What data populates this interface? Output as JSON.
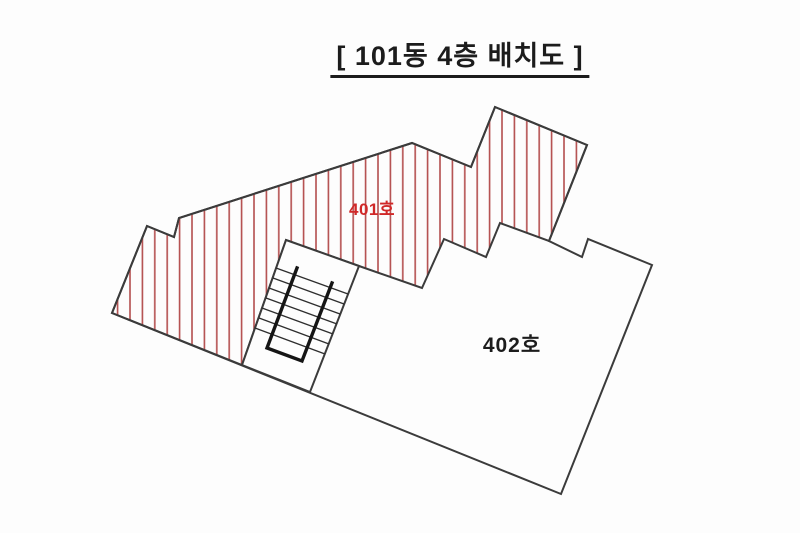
{
  "title": {
    "text": "[ 101동 4층 배치도 ]"
  },
  "units": [
    {
      "id": "401",
      "label": "401호",
      "style": "red-hatched"
    },
    {
      "id": "402",
      "label": "402호",
      "style": "plain"
    }
  ],
  "colors": {
    "background": "#fdfdfd",
    "outline": "#3b3b3b",
    "hatch_line": "#b34d4d",
    "unit401_label": "#d02828",
    "text": "#1c1c1c"
  },
  "hatch": {
    "spacing": 12.4,
    "line_width": 1.6,
    "direction": "vertical"
  },
  "geometry": {
    "outline": "112,313 147,226 174,237 179,218 412,143 471,167 495,107 587,145 549,241 582,257 588,239 652,265 561,494",
    "unit401": "112,313 147,226 174,237 179,218 412,143 471,167 495,107 587,145 549,241 500,223 486,257 444,239 422,288 359,266 286,240 242,365",
    "staircase": "286,240 359,266 310,392 242,365",
    "stair_rail": "297,268 267,348 302,361 332,283",
    "stair_steps": [
      "276,268 348,294",
      "273,278 344,304",
      "269,288 340,314",
      "266,298 337,324",
      "262,308 333,334",
      "259,318 329,344",
      "255,328 325,354"
    ]
  },
  "labels": {
    "unit401": {
      "x": "372",
      "y": "215"
    },
    "unit402": {
      "x": "512",
      "y": "352"
    }
  }
}
